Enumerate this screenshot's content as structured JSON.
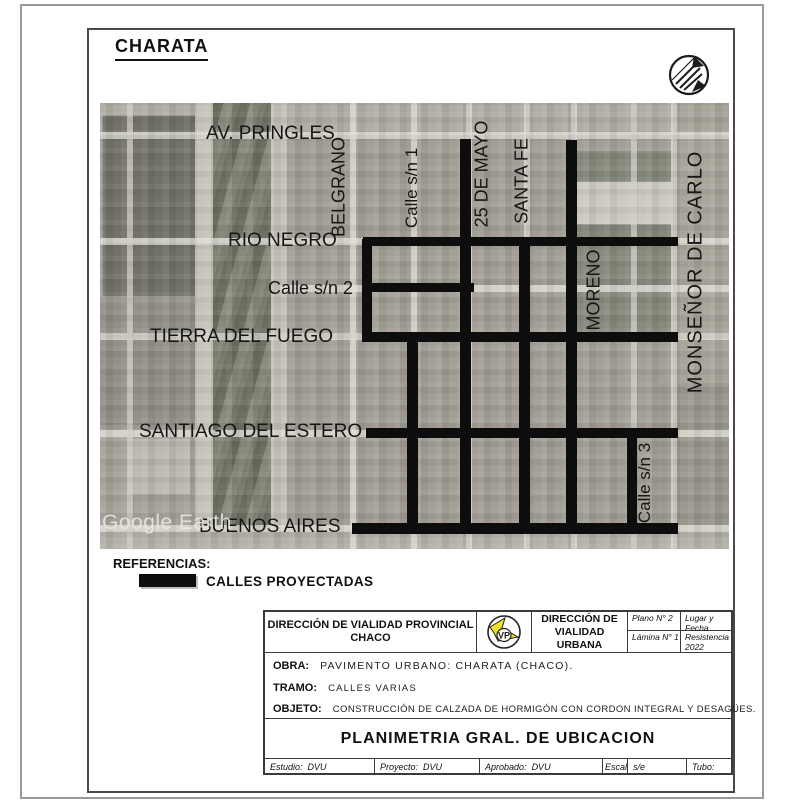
{
  "sheet": {
    "title": "CHARATA"
  },
  "map": {
    "watermark": "Google Earth",
    "labels": {
      "av_pringles": "AV. PRINGLES",
      "belgrano": "BELGRANO",
      "calle_sn1": "Calle s/n 1",
      "veinticinco_de_mayo": "25 DE MAYO",
      "santa_fe": "SANTA FE",
      "rio_negro": "RIO NEGRO",
      "calle_sn2": "Calle s/n 2",
      "moreno": "MORENO",
      "monsenor_de_carlo": "MONSEÑOR DE CARLO",
      "tierra_del_fuego": "TIERRA DEL FUEGO",
      "santiago_del_estero": "SANTIAGO DEL ESTERO",
      "calle_sn3": "Calle s/n 3",
      "buenos_aires": "BUENOS AIRES"
    },
    "projected_color": "#0d0d0d"
  },
  "legend": {
    "heading": "REFERENCIAS:",
    "item_label": "CALLES PROYECTADAS",
    "swatch_color": "#0d0d0d"
  },
  "title_block": {
    "org_left_line1": "DIRECCIÓN DE VIALIDAD PROVINCIAL",
    "org_left_line2": "CHACO",
    "logo_monogram": "VP",
    "logo_color": "#f3df2b",
    "org_right_line1": "DIRECCIÓN DE",
    "org_right_line2": "VIALIDAD URBANA",
    "plano": "Plano N° 2",
    "lamina": "Lámina N° 1",
    "lugar_y_fecha": "Lugar y Fecha",
    "lugar_value_line1": "Resistencia",
    "lugar_value_line2": "2022",
    "obra_label": "OBRA:",
    "obra_value": "PAVIMENTO URBANO: CHARATA (CHACO).",
    "tramo_label": "TRAMO:",
    "tramo_value": "CALLES VARIAS",
    "objeto_label": "OBJETO:",
    "objeto_value": "CONSTRUCCIÓN DE CALZADA DE HORMIGÓN CON CORDON INTEGRAL Y DESAGÜES.",
    "sheet_title": "PLANIMETRIA GRAL. DE UBICACION",
    "estudio_label": "Estudio:",
    "estudio_value": "DVU",
    "proyecto_label": "Proyecto:",
    "proyecto_value": "DVU",
    "aprobado_label": "Aprobado:",
    "aprobado_value": "DVU",
    "escalas_label": "Escalas",
    "escalas_value": "s/e",
    "tubo_label": "Tubo:"
  }
}
